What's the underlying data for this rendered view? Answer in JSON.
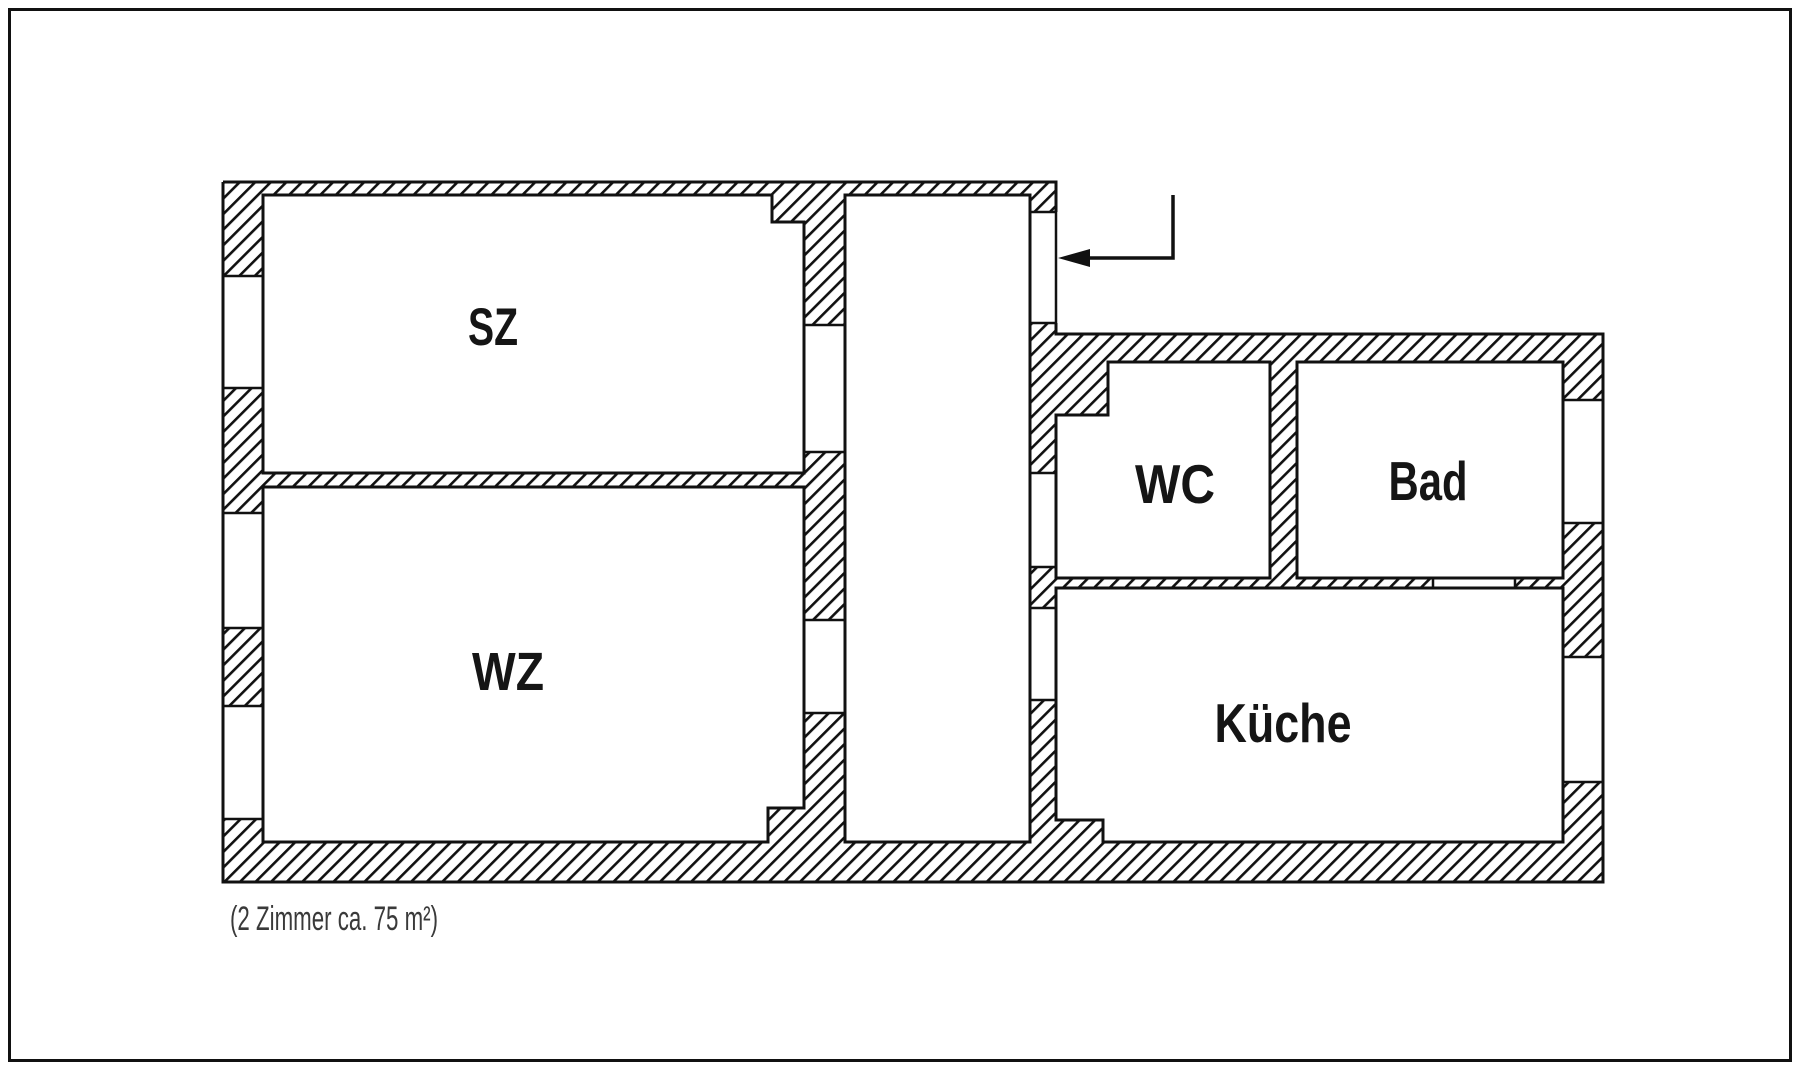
{
  "floorplan": {
    "rooms": [
      {
        "id": "sz",
        "label": "SZ"
      },
      {
        "id": "wz",
        "label": "WZ"
      },
      {
        "id": "wc",
        "label": "WC"
      },
      {
        "id": "bad",
        "label": "Bad"
      },
      {
        "id": "kueche",
        "label": "Küche"
      }
    ],
    "caption": "(2 Zimmer ca. 75 m²)",
    "colors": {
      "wall_line": "#111111",
      "background": "#ffffff",
      "caption_text": "#3a3a3a"
    }
  }
}
